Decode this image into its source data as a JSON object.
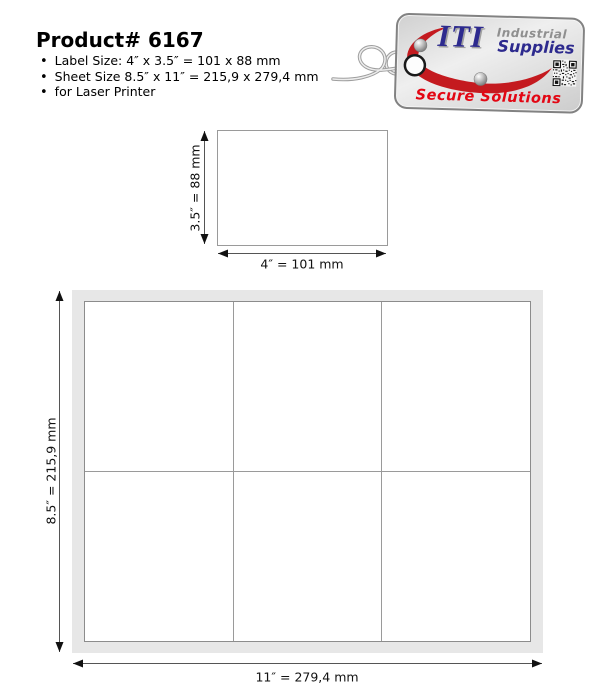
{
  "header": {
    "title": "Product# 6167",
    "bullets": [
      "Label Size: 4″ x 3.5″ = 101 x 88 mm",
      "Sheet Size 8.5″ x 11″ = 215,9 x 279,4 mm",
      "for Laser Printer"
    ]
  },
  "logo": {
    "brand_initials": "ITI",
    "brand_word_top": "Industrial",
    "brand_word_bottom": "Supplies",
    "tagline": "Secure Solutions",
    "colors": {
      "brand_blue": "#2d2a8e",
      "swoosh_red": "#c41a1f",
      "tagline_red": "#e30613",
      "tag_fill": "#dcdcdc",
      "tag_border": "#828282"
    }
  },
  "label_diagram": {
    "height_label": "3.5″ = 88 mm",
    "width_label": "4″ = 101 mm"
  },
  "sheet_diagram": {
    "height_label": "8.5″ = 215,9 mm",
    "width_label": "11″ = 279,4 mm",
    "rows": 2,
    "columns": 3
  }
}
